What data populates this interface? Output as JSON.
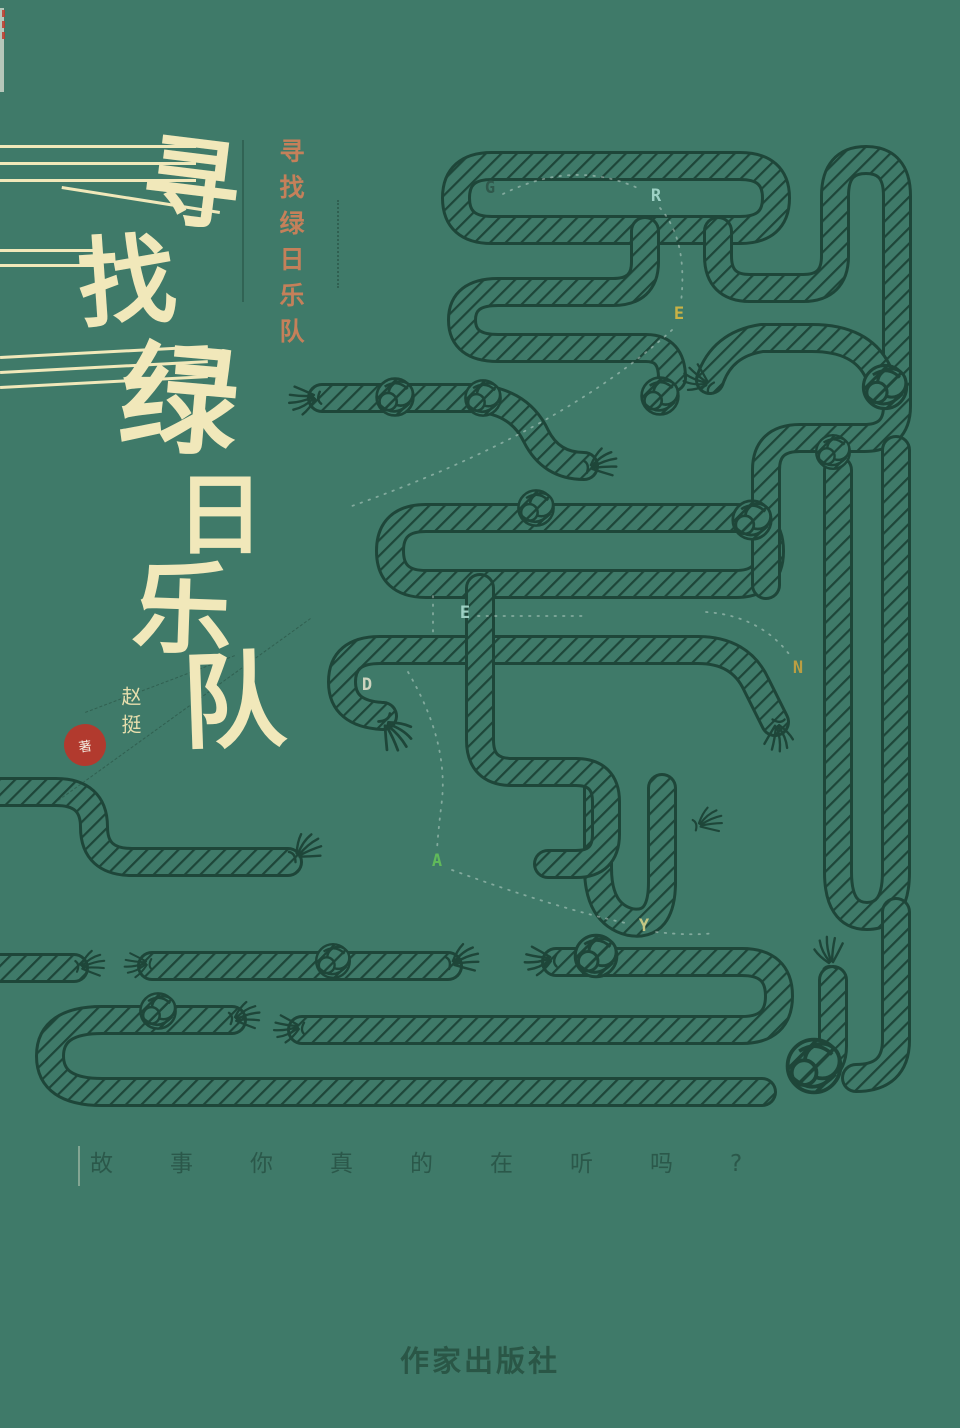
{
  "background_color": "#3f7a69",
  "rope_color": "#1e4639",
  "title": {
    "text": "寻找绿日乐队",
    "chars": [
      "寻",
      "找",
      "绿",
      "日",
      "乐",
      "队"
    ],
    "color": "#f1e8ba"
  },
  "subtitle": {
    "text": "寻找绿日乐队",
    "color": "#c5805a"
  },
  "author": {
    "name": "赵挺",
    "seal": "著",
    "seal_color": "#b23a2e",
    "name_color": "#e8dfae"
  },
  "hidden_word": {
    "word": "GREEN DAY",
    "letters": [
      {
        "ch": "G",
        "x": 490,
        "y": 193,
        "color": "#2f574a"
      },
      {
        "ch": "R",
        "x": 656,
        "y": 201,
        "color": "#a3d6c9"
      },
      {
        "ch": "E",
        "x": 679,
        "y": 319,
        "color": "#d2b544"
      },
      {
        "ch": "E",
        "x": 465,
        "y": 618,
        "color": "#a3d6c9"
      },
      {
        "ch": "N",
        "x": 798,
        "y": 673,
        "color": "#c2a040"
      },
      {
        "ch": "D",
        "x": 367,
        "y": 690,
        "color": "#d6d9c4"
      },
      {
        "ch": "A",
        "x": 437,
        "y": 866,
        "color": "#62bd5a"
      },
      {
        "ch": "Y",
        "x": 644,
        "y": 931,
        "color": "#cbcb85"
      }
    ]
  },
  "tagline": {
    "text": "故事你真的在听吗?",
    "color": "#2b584a"
  },
  "publisher": {
    "name": "作家出版社",
    "color": "#2a5646"
  }
}
